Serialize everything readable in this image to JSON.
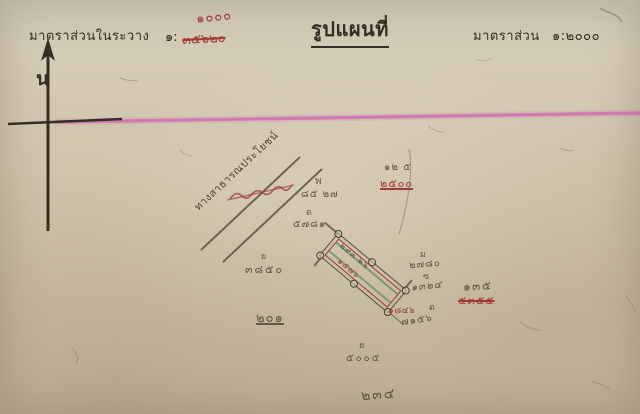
{
  "colors": {
    "paper": "#d0c5ae",
    "ink": "#332e26",
    "pencil": "#56503f",
    "red": "#a13b33",
    "dark_red": "#8a4038",
    "magenta": "#d06aae",
    "green": "#57855f",
    "parcel_red": "#943c3c"
  },
  "header": {
    "left_label": "มาตราส่วนในระวาง",
    "left_scale_prefix": "๑:",
    "left_scale_struck": "๓๕๖๒๐",
    "left_scale_corrected": "๑๐๐๐",
    "title": "รูปแผนที่",
    "right_label": "มาตราส่วน",
    "right_scale": "๑:๒๐๐๐"
  },
  "compass": {
    "north_letter": "น"
  },
  "road": {
    "label": "ทางสาธารณประโยชน์"
  },
  "parcel": {
    "pencil_label": "๒๙๓ ๒๖",
    "red_label": "๑๕๗๖"
  },
  "marks": {
    "nw_pencil_1": "พ",
    "nw_pencil_2": "๘๕ ๒๗",
    "nw_pencil_3": "ด",
    "nw_pencil_4": "๕๗๘๑",
    "ne_pencil": "๑๒ ๕",
    "ne_red": "๒๕๐๐",
    "west_pencil_1": "ย",
    "west_pencil_2": "๓๘๕๐",
    "south_pencil": "๒๐๑",
    "east_pencil_1": "ม",
    "east_pencil_2": "๒๗๘๐",
    "east_pencil_3": "ซ",
    "east_pencil_4": "๑๓๒๔",
    "east_red": "๑๘๔๖",
    "east_pencil_5": "ด",
    "east_pencil_6": "๗๑๕๖",
    "far_east_pencil": "๑๓๕",
    "far_east_red": "๕๓๕๕",
    "bottom_pencil_1": "ย",
    "bottom_pencil_2": "๕๐๐๕",
    "bottom_pencil_3": "๒๓๔"
  }
}
